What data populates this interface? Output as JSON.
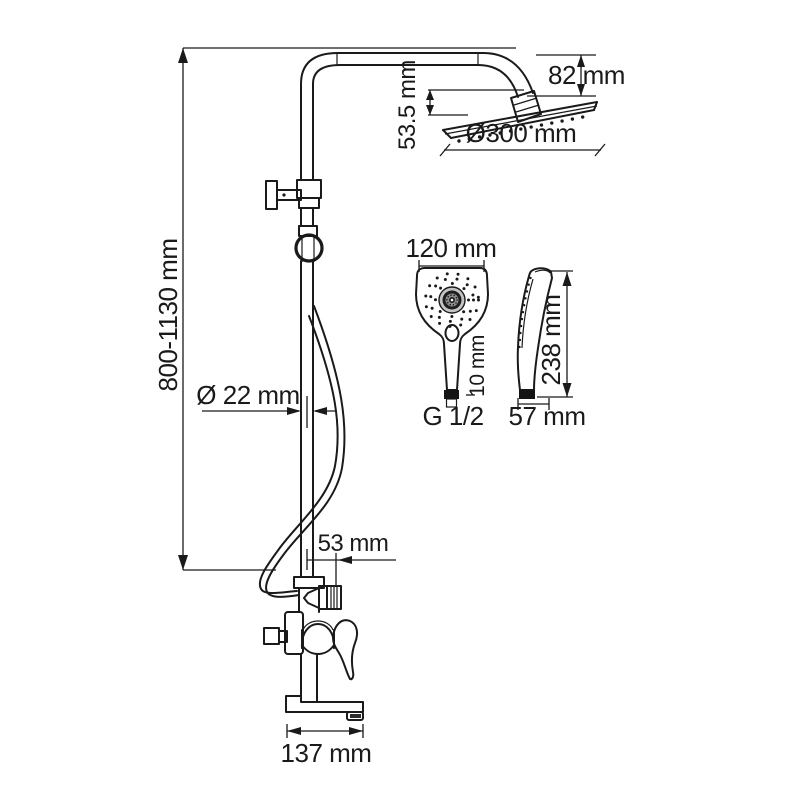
{
  "drawing": {
    "type": "technical-dimension-drawing",
    "subject": "shower-column-system",
    "colors": {
      "line": "#1a1a1a",
      "background": "#ffffff",
      "dark_fill": "#1e1e1e",
      "gray_fill": "#c4c4c4",
      "mid_gray": "#8f8f8f"
    },
    "labels": {
      "arm_height": "82 mm",
      "head_drop": "53.5 mm",
      "head_diameter": "Ø300 mm",
      "column_height": "800-1130 mm",
      "pipe_diameter": "Ø 22 mm",
      "hand_shower_width": "120 mm",
      "connector_height": "10 mm",
      "thread": "G 1/2",
      "hand_shower_length": "238 mm",
      "hand_shower_depth": "57 mm",
      "hose_outlet_offset": "53 mm",
      "spout_reach": "137 mm"
    }
  }
}
